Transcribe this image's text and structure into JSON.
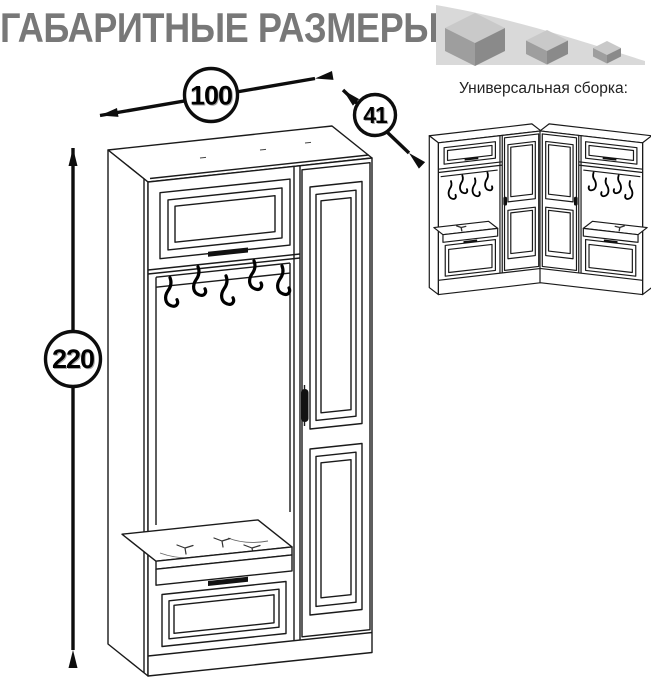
{
  "title": "ГАБАРИТНЫЕ РАЗМЕРЫ",
  "dimensions": {
    "width_cm": "100",
    "depth_cm": "41",
    "height_cm": "220"
  },
  "assembly": {
    "heading": "Универсальная сборка:"
  },
  "icons": {
    "size_cubes": "shrinking-cubes-icon"
  },
  "colors": {
    "title_gray": "#787878",
    "line_black": "#1a1a1a",
    "swoosh_gray": "#d9d9d9",
    "cube_top_gray": "#c9c9c9",
    "cube_left_gray": "#9e9e9e",
    "cube_right_gray": "#8a8a8a"
  }
}
